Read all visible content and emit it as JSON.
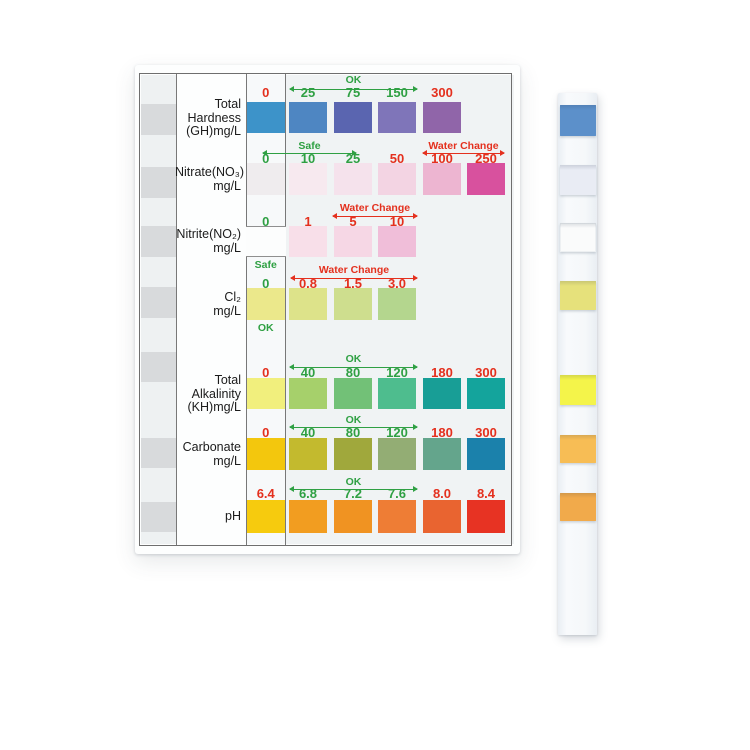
{
  "colors": {
    "green": "#2fa043",
    "red": "#e4301e",
    "line_gray": "#787878"
  },
  "chart": {
    "description": "Water test strip color comparison chart",
    "rows": [
      {
        "id": "total-hardness",
        "label_lines": [
          "Total",
          "Hardness",
          "(GH)mg/L"
        ],
        "label_top": 33,
        "numbers_y": 21,
        "swatch_y": 37,
        "swatch_h": 31,
        "zero": {
          "value": "0",
          "color": "red",
          "swatch": "#3d93c9"
        },
        "cells": [
          {
            "value": "25",
            "color": "green",
            "swatch": "#4e86c2",
            "col": 0
          },
          {
            "value": "75",
            "color": "green",
            "swatch": "#5a65b0",
            "col": 1
          },
          {
            "value": "150",
            "color": "green",
            "swatch": "#7f75b9",
            "col": 2
          },
          {
            "value": "300",
            "color": "red",
            "swatch": "#9065a9",
            "col": 3
          }
        ],
        "annotations": [
          {
            "text": "OK",
            "color": "green",
            "x1": 155,
            "x2": 282,
            "text_y": 10,
            "arrow_y": 24
          }
        ]
      },
      {
        "id": "nitrate",
        "label_lines": [
          "Nitrate(NO₃)",
          "mg/L"
        ],
        "label_top": 101,
        "numbers_y": 87,
        "swatch_y": 98,
        "swatch_h": 32,
        "zero": {
          "value": "0",
          "color": "green",
          "swatch": "#efecee"
        },
        "cells": [
          {
            "value": "10",
            "color": "green",
            "swatch": "#f7e9ef",
            "col": 0
          },
          {
            "value": "25",
            "color": "green",
            "swatch": "#f5e2ec",
            "col": 1
          },
          {
            "value": "50",
            "color": "red",
            "swatch": "#f3d4e3",
            "col": 2
          },
          {
            "value": "100",
            "color": "red",
            "swatch": "#edb5d1",
            "col": 3
          },
          {
            "value": "250",
            "color": "red",
            "swatch": "#d8519e",
            "col": 4
          }
        ],
        "annotations": [
          {
            "text": "Safe",
            "color": "green",
            "x1": 128,
            "x2": 221,
            "text_y": 76,
            "arrow_y": 88
          },
          {
            "text": "Water Change",
            "color": "red",
            "x1": 288,
            "x2": 369,
            "text_y": 76,
            "arrow_y": 88
          }
        ]
      },
      {
        "id": "nitrite",
        "label_lines": [
          "Nitrite(NO₂)",
          "mg/L"
        ],
        "label_top": 163,
        "numbers_y": 150,
        "swatch_y": 161,
        "swatch_h": 31,
        "zero": {
          "value": "0",
          "color": "green",
          "swatch": null,
          "boxed": true,
          "below": "Safe"
        },
        "cells": [
          {
            "value": "1",
            "color": "red",
            "swatch": "#f8dfe9",
            "col": 0
          },
          {
            "value": "5",
            "color": "red",
            "swatch": "#f6d7e5",
            "col": 1
          },
          {
            "value": "10",
            "color": "red",
            "swatch": "#f0bed9",
            "col": 2
          }
        ],
        "annotations": [
          {
            "text": "Water Change",
            "color": "red",
            "x1": 198,
            "x2": 282,
            "text_y": 138,
            "arrow_y": 151
          }
        ]
      },
      {
        "id": "chlorine",
        "label_lines": [
          "Cl₂",
          "mg/L"
        ],
        "label_top": 226,
        "numbers_y": 212,
        "swatch_y": 223,
        "swatch_h": 32,
        "zero": {
          "value": "0",
          "color": "green",
          "swatch": "#ebe88b",
          "below": "OK"
        },
        "cells": [
          {
            "value": "0.8",
            "color": "red",
            "swatch": "#dde38a",
            "col": 0
          },
          {
            "value": "1.5",
            "color": "red",
            "swatch": "#cede8e",
            "col": 1
          },
          {
            "value": "3.0",
            "color": "red",
            "swatch": "#b4d68e",
            "col": 2
          }
        ],
        "annotations": [
          {
            "text": "Water Change",
            "color": "red",
            "x1": 156,
            "x2": 282,
            "text_y": 200,
            "arrow_y": 213
          }
        ]
      },
      {
        "id": "total-alkalinity",
        "label_lines": [
          "Total",
          "Alkalinity",
          "(KH)mg/L"
        ],
        "label_top": 309,
        "numbers_y": 301,
        "swatch_y": 313,
        "swatch_h": 31,
        "zero": {
          "value": "0",
          "color": "red",
          "swatch": "#f1ef7d"
        },
        "cells": [
          {
            "value": "40",
            "color": "green",
            "swatch": "#a6d06b",
            "col": 0
          },
          {
            "value": "80",
            "color": "green",
            "swatch": "#72c177",
            "col": 1
          },
          {
            "value": "120",
            "color": "green",
            "swatch": "#4ebd8e",
            "col": 2
          },
          {
            "value": "180",
            "color": "red",
            "swatch": "#189e96",
            "col": 3
          },
          {
            "value": "300",
            "color": "red",
            "swatch": "#14a49c",
            "col": 4
          }
        ],
        "annotations": [
          {
            "text": "OK",
            "color": "green",
            "x1": 155,
            "x2": 282,
            "text_y": 289,
            "arrow_y": 302
          }
        ]
      },
      {
        "id": "carbonate",
        "label_lines": [
          "Carbonate",
          "mg/L"
        ],
        "label_top": 376,
        "numbers_y": 361,
        "swatch_y": 373,
        "swatch_h": 32,
        "zero": {
          "value": "0",
          "color": "red",
          "swatch": "#f3c70d"
        },
        "cells": [
          {
            "value": "40",
            "color": "green",
            "swatch": "#c3ba2e",
            "col": 0
          },
          {
            "value": "80",
            "color": "green",
            "swatch": "#a0a83c",
            "col": 1
          },
          {
            "value": "120",
            "color": "green",
            "swatch": "#93ad74",
            "col": 2
          },
          {
            "value": "180",
            "color": "red",
            "swatch": "#64a58c",
            "col": 3
          },
          {
            "value": "300",
            "color": "red",
            "swatch": "#1b81ab",
            "col": 4
          }
        ],
        "annotations": [
          {
            "text": "OK",
            "color": "green",
            "x1": 155,
            "x2": 282,
            "text_y": 350,
            "arrow_y": 362
          }
        ]
      },
      {
        "id": "ph",
        "label_lines": [
          "pH"
        ],
        "label_top": 445,
        "numbers_y": 422,
        "swatch_y": 435,
        "swatch_h": 33,
        "zero": {
          "value": "6.4",
          "color": "red",
          "swatch": "#f6cb0e"
        },
        "cells": [
          {
            "value": "6.8",
            "color": "green",
            "swatch": "#f29d20",
            "col": 0
          },
          {
            "value": "7.2",
            "color": "green",
            "swatch": "#f09322",
            "col": 1
          },
          {
            "value": "7.6",
            "color": "green",
            "swatch": "#ee7d35",
            "col": 2
          },
          {
            "value": "8.0",
            "color": "red",
            "swatch": "#e96430",
            "col": 3
          },
          {
            "value": "8.4",
            "color": "red",
            "swatch": "#e73323",
            "col": 4
          }
        ],
        "annotations": [
          {
            "text": "OK",
            "color": "green",
            "x1": 155,
            "x2": 282,
            "text_y": 412,
            "arrow_y": 424
          }
        ]
      }
    ]
  },
  "mini_strip": {
    "bands": [
      {
        "y": 39,
        "h": 31
      },
      {
        "y": 102,
        "h": 31
      },
      {
        "y": 161,
        "h": 31
      },
      {
        "y": 222,
        "h": 31
      },
      {
        "y": 287,
        "h": 30
      },
      {
        "y": 373,
        "h": 30
      },
      {
        "y": 437,
        "h": 30
      }
    ]
  },
  "test_strip": {
    "pads": [
      {
        "name": "total-hardness-pad",
        "color": "#5c90ca",
        "y": 12,
        "h": 31
      },
      {
        "name": "nitrate-pad",
        "color": "#e9ecf4",
        "y": 72,
        "h": 30
      },
      {
        "name": "nitrite-pad",
        "color": "#fafbfb",
        "y": 130,
        "h": 29
      },
      {
        "name": "chlorine-pad",
        "color": "#e6e17b",
        "y": 188,
        "h": 29
      },
      {
        "name": "alkalinity-pad",
        "color": "#f4f44a",
        "y": 282,
        "h": 30
      },
      {
        "name": "carbonate-pad",
        "color": "#f7bd55",
        "y": 342,
        "h": 28
      },
      {
        "name": "ph-pad",
        "color": "#f1aa4b",
        "y": 400,
        "h": 28
      }
    ]
  }
}
